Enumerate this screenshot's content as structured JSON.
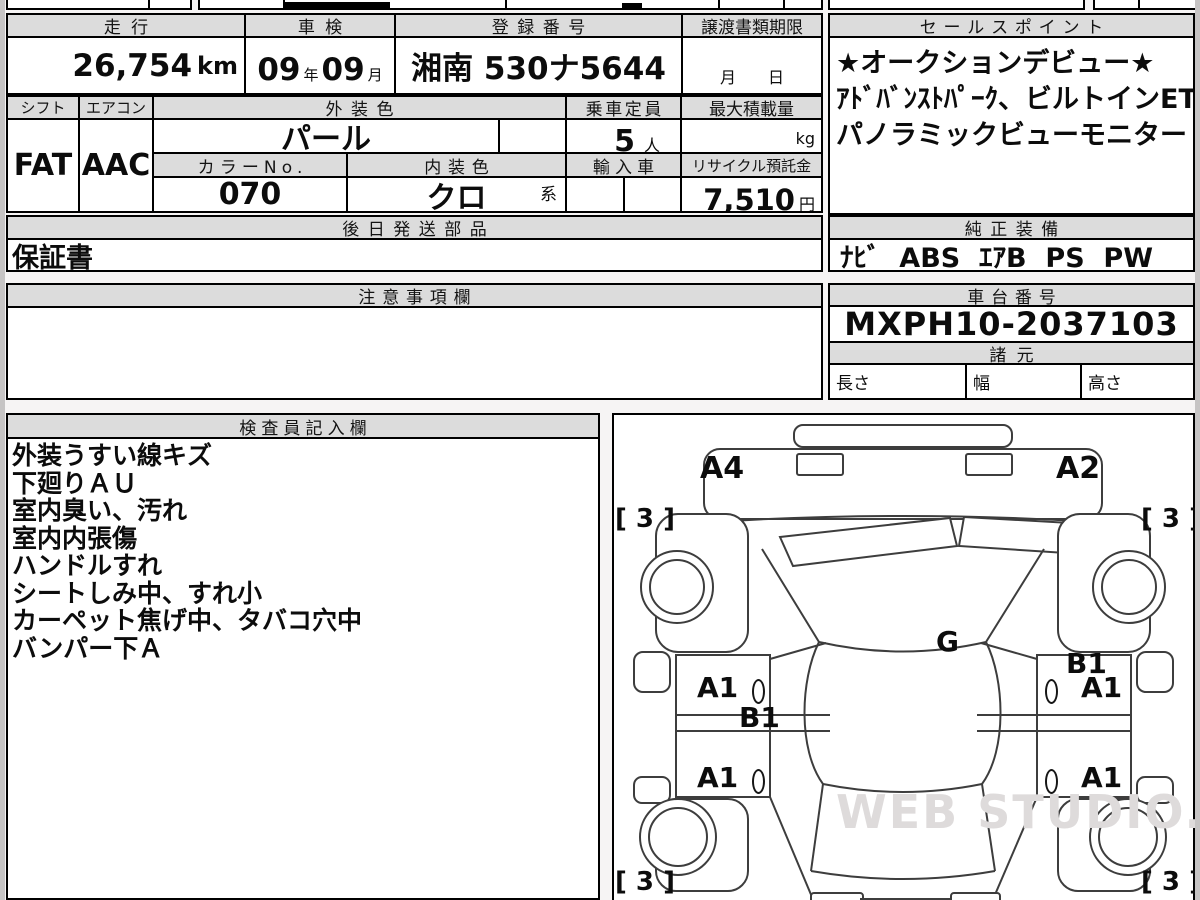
{
  "summary": {
    "mileage_label": "走行",
    "mileage_value": "26,754",
    "mileage_unit": "km",
    "inspection_label": "車検",
    "inspection_year": "09",
    "inspection_year_unit": "年",
    "inspection_month": "09",
    "inspection_month_unit": "月",
    "registration_label": "登録番号",
    "registration_value": "湘南 530ナ5644",
    "transfer_label": "譲渡書類期限",
    "transfer_value": "月　　日"
  },
  "details": {
    "shift_label": "シフト",
    "shift_value": "FAT",
    "aircon_label": "エアコン",
    "aircon_value": "AAC",
    "exterior_label": "外装色",
    "exterior_value": "パール",
    "capacity_label": "乗車定員",
    "capacity_value": "5",
    "capacity_unit": "人",
    "max_load_label": "最大積載量",
    "max_load_unit": "kg",
    "color_no_label": "カラーNo.",
    "color_no_value": "070",
    "interior_label": "内装色",
    "interior_value": "クロ",
    "interior_suffix": "系",
    "import_label": "輸入車",
    "recycle_label": "リサイクル預託金",
    "recycle_value": "7,510",
    "recycle_unit": "円"
  },
  "later_parts": {
    "label": "後日発送部品",
    "value": "保証書"
  },
  "cautions": {
    "label": "注意事項欄",
    "value": ""
  },
  "sales_points": {
    "label": "セールスポイント",
    "line1": "★オークションデビュー★",
    "line2": "ｱﾄﾞﾊﾞﾝｽﾄﾊﾟｰｸ、ビルトインETC2.0",
    "line3": "パノラミックビューモニター"
  },
  "equipment": {
    "label": "純正装備",
    "value": "ﾅﾋﾞ  ABS  ｴｱB  PS  PW"
  },
  "chassis": {
    "label": "車台番号",
    "value": "MXPH10-2037103"
  },
  "specs": {
    "label": "諸元",
    "length_label": "長さ",
    "width_label": "幅",
    "height_label": "高さ"
  },
  "inspector": {
    "label": "検査員記入欄",
    "lines": [
      "外装うすい線キズ",
      "下廻りＡＵ",
      "室内臭い、汚れ",
      "室内内張傷",
      "ハンドルすれ",
      "シートしみ中、すれ小",
      "カーペット焦げ中、タバコ穴中",
      "バンパー下Ａ"
    ]
  },
  "diagram": {
    "front_left_mark": "A4",
    "front_right_mark": "A2",
    "tire_front_left": "[ 3 ]",
    "tire_front_right": "[ 3 ]",
    "tire_rear_left": "[ 3 ]",
    "tire_rear_right": "[ 3 ]",
    "glass_mark": "G",
    "left_pillar_mark": "B1",
    "right_quarter_mark": "B1",
    "door_front_left_mark": "A1",
    "door_front_right_mark": "A1",
    "door_rear_left_mark": "A1",
    "door_rear_right_mark": "A1",
    "watermark": "WEB STUDIO.RU"
  }
}
